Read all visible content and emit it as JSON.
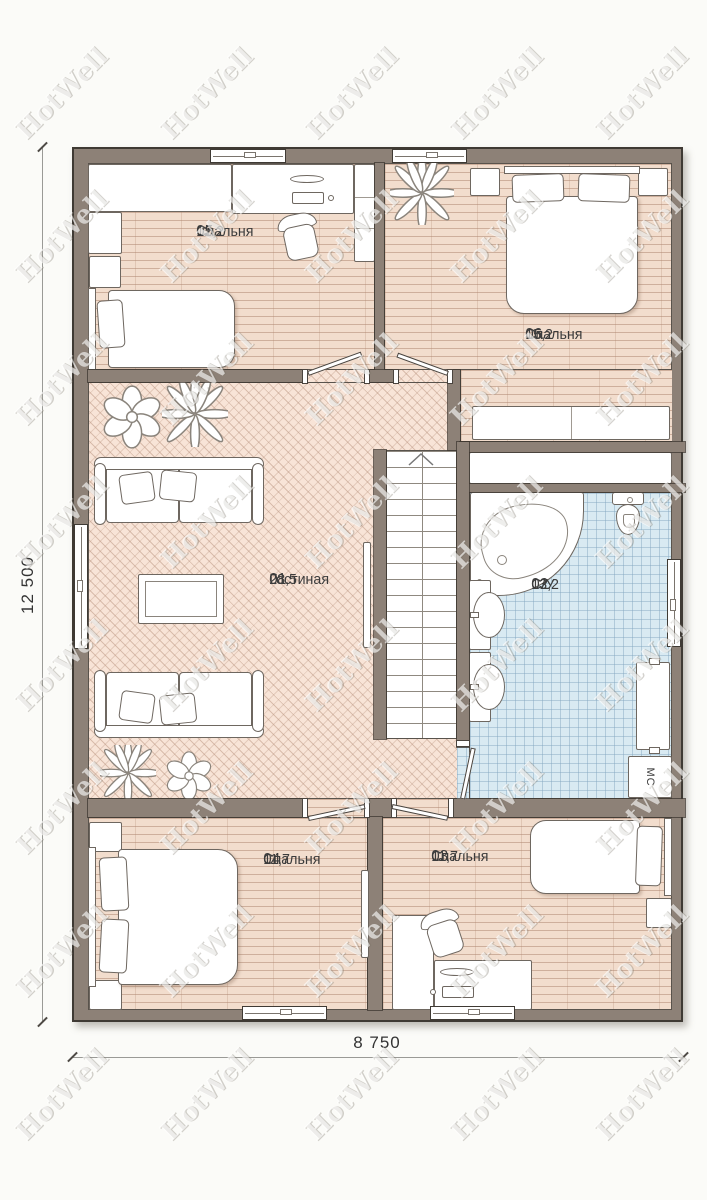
{
  "watermark": {
    "text": "HotWell"
  },
  "dimensions": {
    "height_label": "12 500",
    "width_label": "8 750"
  },
  "rooms": [
    {
      "id": "01",
      "name": "Гостиная",
      "area": "28,5"
    },
    {
      "id": "02",
      "name": "С/У",
      "area": "13,2"
    },
    {
      "id": "03",
      "name": "Спальня",
      "area": "11,7"
    },
    {
      "id": "04",
      "name": "Спальня",
      "area": "11,7"
    },
    {
      "id": "05",
      "name": "Спальня",
      "area": "12,2"
    },
    {
      "id": "06",
      "name": "Спальня",
      "area": "15,2"
    }
  ],
  "appliances": {
    "washing_machine_label": "МС"
  },
  "colors": {
    "wall": "#8d8177",
    "wood": "#f2ddcd",
    "herringbone": "#f8e4d7",
    "tile": "#d9eaf2",
    "ink": "#3c3c3c",
    "outline": "#6e6760"
  }
}
